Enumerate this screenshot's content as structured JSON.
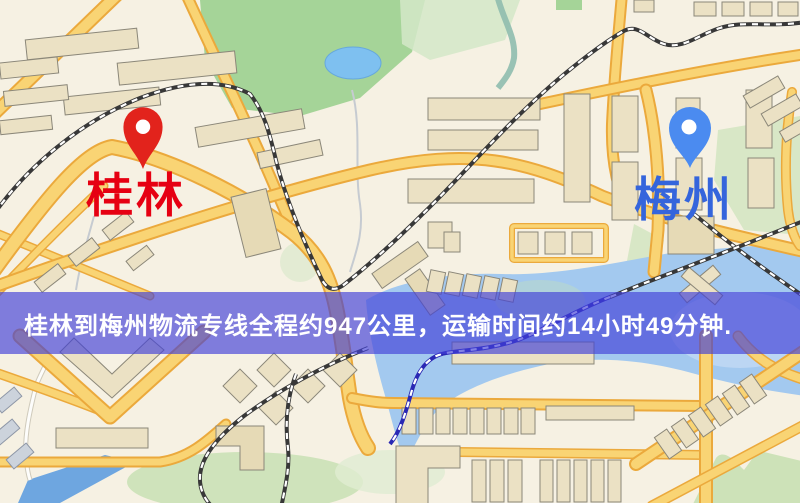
{
  "map": {
    "origin": {
      "label": "桂林",
      "pin_color": "#e2231c",
      "label_color": "#e60012"
    },
    "destination": {
      "label": "梅州",
      "pin_color": "#4b8bf0",
      "label_color": "#3565dc"
    },
    "banner": {
      "text": "桂林到梅州物流专线全程约947公里，运输时间约14小时49分钟.",
      "background_color": "#4240d8",
      "text_color": "#ffffff",
      "distance_km": "947",
      "duration": "14小时49分钟"
    },
    "palette": {
      "background": "#f6f1e3",
      "road_fill": "#f9d474",
      "road_casing": "#eba93c",
      "water": "#a3c9ef",
      "lake": "#7ec0f0",
      "park_bright": "#a5d498",
      "park_pale": "#d8e7c6",
      "building": "#ebe1c4",
      "railway": "#383838",
      "railway_over_water": "#2a28b4"
    }
  }
}
